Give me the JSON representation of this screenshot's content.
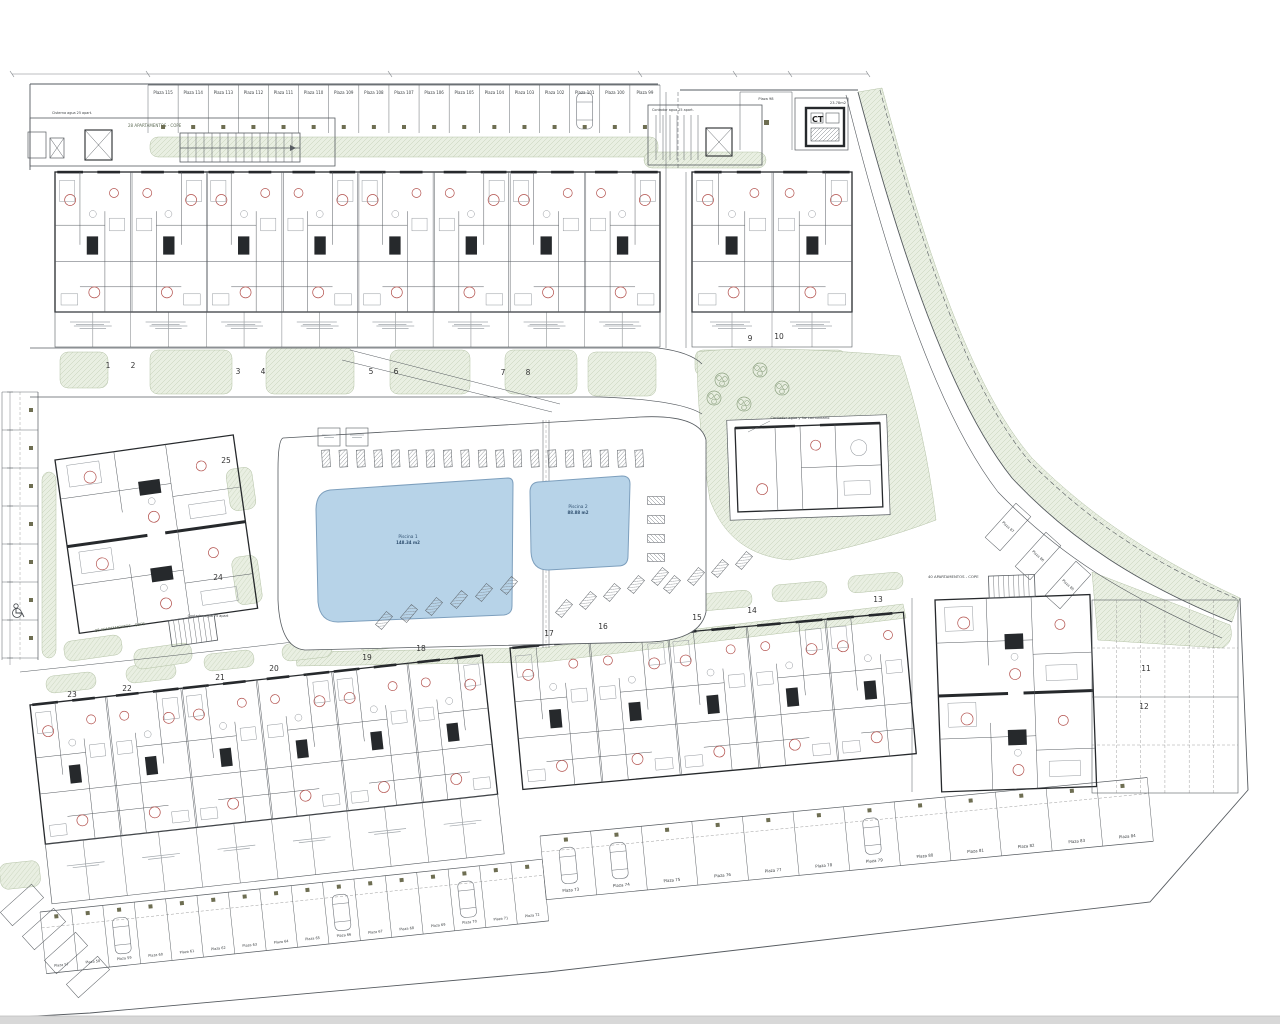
{
  "colors": {
    "line": "#565b60",
    "wall": "#26292c",
    "red": "#b3524e",
    "green_fill": "#e9efe2",
    "green_line": "#b4c2a6",
    "pool_fill": "#b7d3e8",
    "pool_line": "#7d9fbd",
    "faux": "#a0a6ab",
    "meter_box": "#6e6e52",
    "footer_bar": "#d8d8d8"
  },
  "annotations": {
    "cisterna_label": "Cisterna agua 25 apart.",
    "top_block_label": "28 APARTAMENTOS - COPE",
    "contador_top_label": "Contador agua 25 apart.",
    "ct_label": "CT",
    "ct_area": "23.78m2",
    "community_label": "Contador agua y luz comunitario",
    "contador_75_label": "Contador agua 75 apart",
    "mid_left_block_label": "28 APARTAMENTOS - COPE",
    "bottom_right_block_label": "40 APARTAMENTOS - COPE"
  },
  "pools": {
    "pool1": {
      "name": "Piscina 1",
      "area": "148.34 m2"
    },
    "pool2": {
      "name": "Piscina 2",
      "area": "88.88 m2"
    }
  },
  "units": {
    "top": [
      "1",
      "2",
      "3",
      "4",
      "5",
      "6",
      "7",
      "8"
    ],
    "right": [
      "9",
      "10"
    ],
    "mid_left": [
      "25",
      "24"
    ],
    "bottom_left": [
      "23",
      "22",
      "21",
      "20",
      "19",
      "18"
    ],
    "bottom_center": [
      "17",
      "16",
      "15",
      "14",
      "13"
    ],
    "bottom_right": [
      "11",
      "12"
    ]
  },
  "parking": {
    "single": "Plaza 98",
    "top_row": [
      "Plaza 115",
      "Plaza 114",
      "Plaza 113",
      "Plaza 112",
      "Plaza 111",
      "Plaza 110",
      "Plaza 109",
      "Plaza 108",
      "Plaza 107",
      "Plaza 106",
      "Plaza 105",
      "Plaza 104",
      "Plaza 103",
      "Plaza 102",
      "Plaza 101",
      "Plaza 100",
      "Plaza 99"
    ],
    "curve_stalls": [
      "Plaza 87",
      "Plaza 86",
      "Plaza 85"
    ],
    "middle_row": [
      "Plaza 73",
      "Plaza 74",
      "Plaza 75",
      "Plaza 76",
      "Plaza 77",
      "Plaza 78",
      "Plaza 79",
      "Plaza 80",
      "Plaza 81",
      "Plaza 82",
      "Plaza 83",
      "Plaza 84"
    ],
    "bottom_row": [
      "Plaza 57",
      "Plaza 58",
      "Plaza 59",
      "Plaza 60",
      "Plaza 61",
      "Plaza 62",
      "Plaza 63",
      "Plaza 64",
      "Plaza 65",
      "Plaza 66",
      "Plaza 67",
      "Plaza 68",
      "Plaza 69",
      "Plaza 70",
      "Plaza 71",
      "Plaza 72"
    ]
  }
}
